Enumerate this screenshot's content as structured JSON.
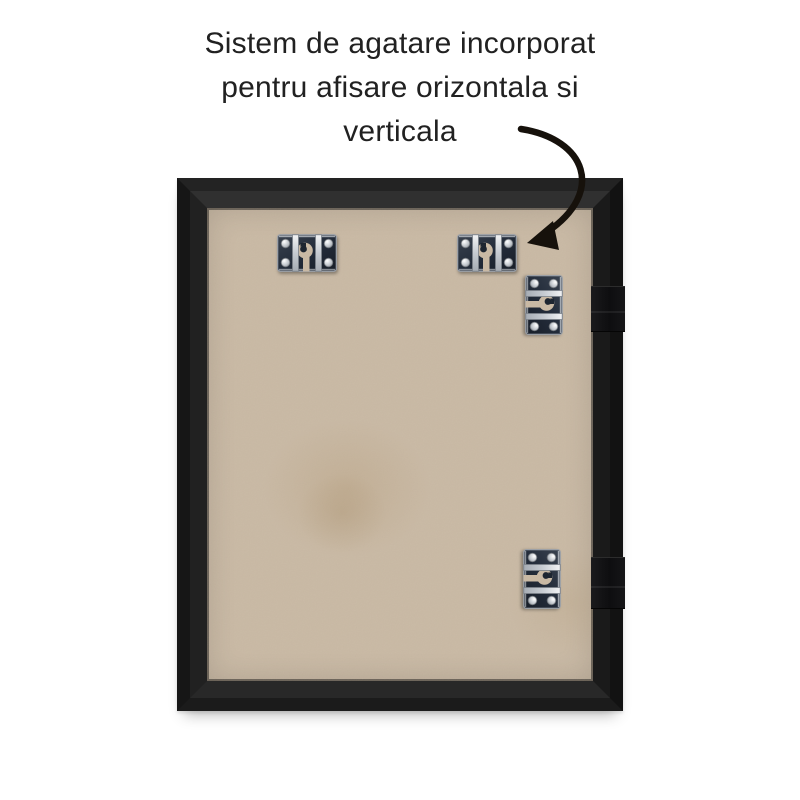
{
  "caption": {
    "lines": [
      "Sistem de agatare incorporat",
      "pentru afisare orizontala si",
      "verticala"
    ]
  },
  "colors": {
    "background": "#ffffff",
    "caption_text": "#212121",
    "frame_black": "#1c1c1c",
    "backing_board_tan": "#c9b9a4",
    "hanger_metal_silver": "#d9dcdf",
    "hanger_plate_navy": "#232c3a",
    "arrow_black": "#16110b"
  },
  "hardware": {
    "hanger_type": "keyhole-hanger",
    "horizontal_hanger_count": 2,
    "vertical_hanger_count": 2
  }
}
